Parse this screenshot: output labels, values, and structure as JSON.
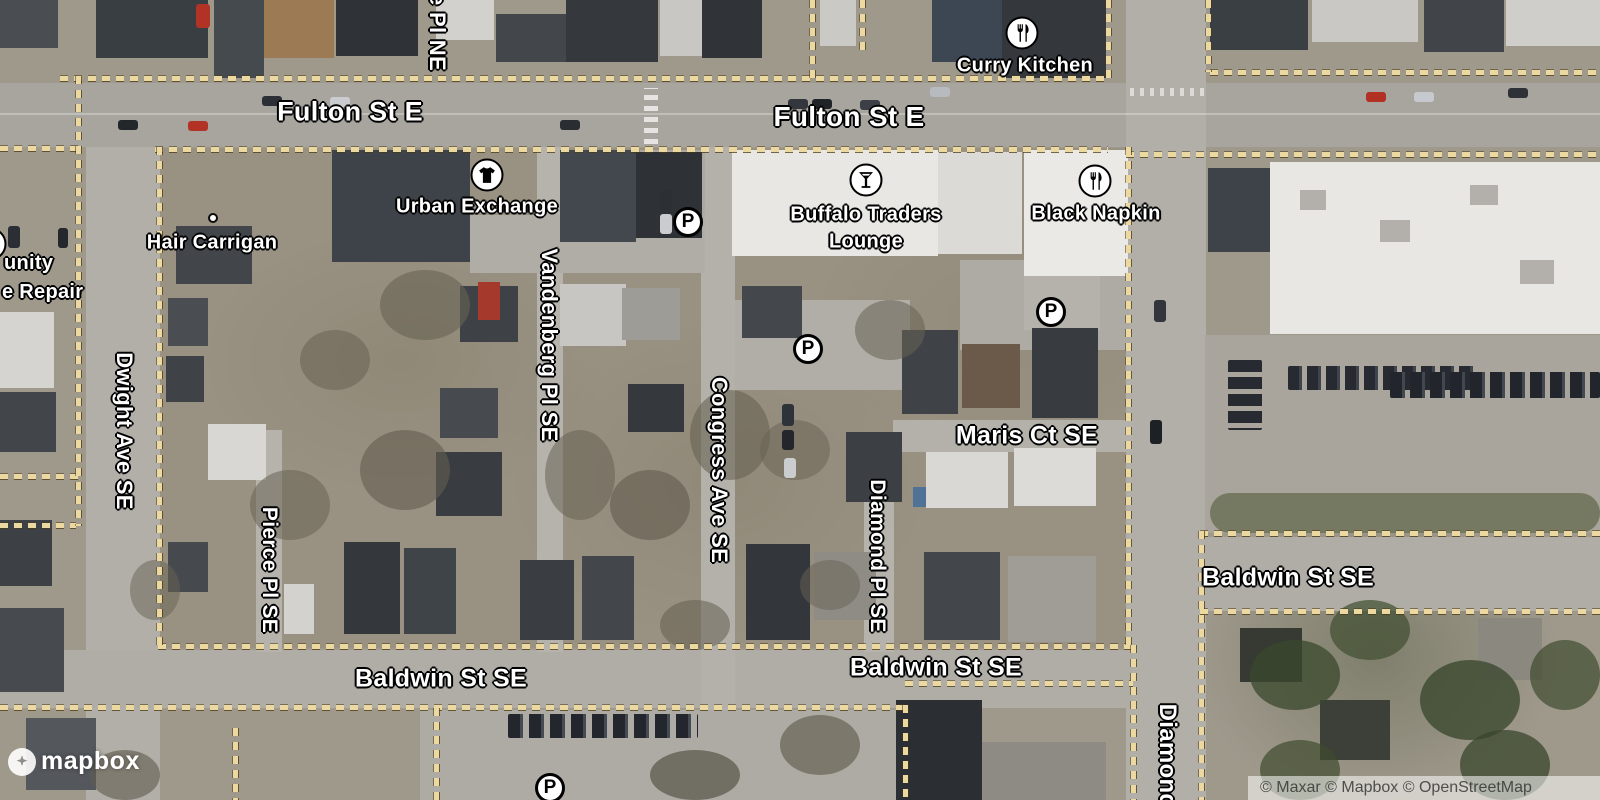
{
  "map": {
    "provider_logo": "mapbox",
    "attribution": "© Maxar © Mapbox © OpenStreetMap",
    "parking_symbol": "P",
    "street_labels": {
      "fulton_st_e_west": "Fulton St E",
      "fulton_st_e_east": "Fulton St E",
      "dwight_ave_se": "Dwight Ave SE",
      "pierce_pl_se": "Pierce Pl SE",
      "vandenberg_pl_se": "Vandenberg Pl SE",
      "congress_ave_se": "Congress Ave SE",
      "diamond_pl_se": "Diamond Pl SE",
      "maris_ct_se": "Maris Ct SE",
      "baldwin_st_se_west": "Baldwin St SE",
      "baldwin_st_se_center": "Baldwin St SE",
      "baldwin_st_se_east": "Baldwin St SE",
      "diamond_partial_right": "Diamond",
      "pl_ne_partial_top": "e Pl NE"
    },
    "poi_labels": {
      "curry_kitchen": "Curry Kitchen",
      "urban_exchange": "Urban Exchange",
      "hair_carrigan": "Hair Carrigan",
      "buffalo_traders_line1": "Buffalo Traders",
      "buffalo_traders_line2": "Lounge",
      "black_napkin": "Black Napkin",
      "left_edge_partial_line1": "unity",
      "left_edge_partial_line2": "e Repair"
    },
    "colors": {
      "boundary_dash": "#ecd9a2",
      "label_text": "#ffffff",
      "label_halo": "#000000",
      "road": "#b2afa9",
      "attribution_text": "#3f3f3f"
    }
  }
}
